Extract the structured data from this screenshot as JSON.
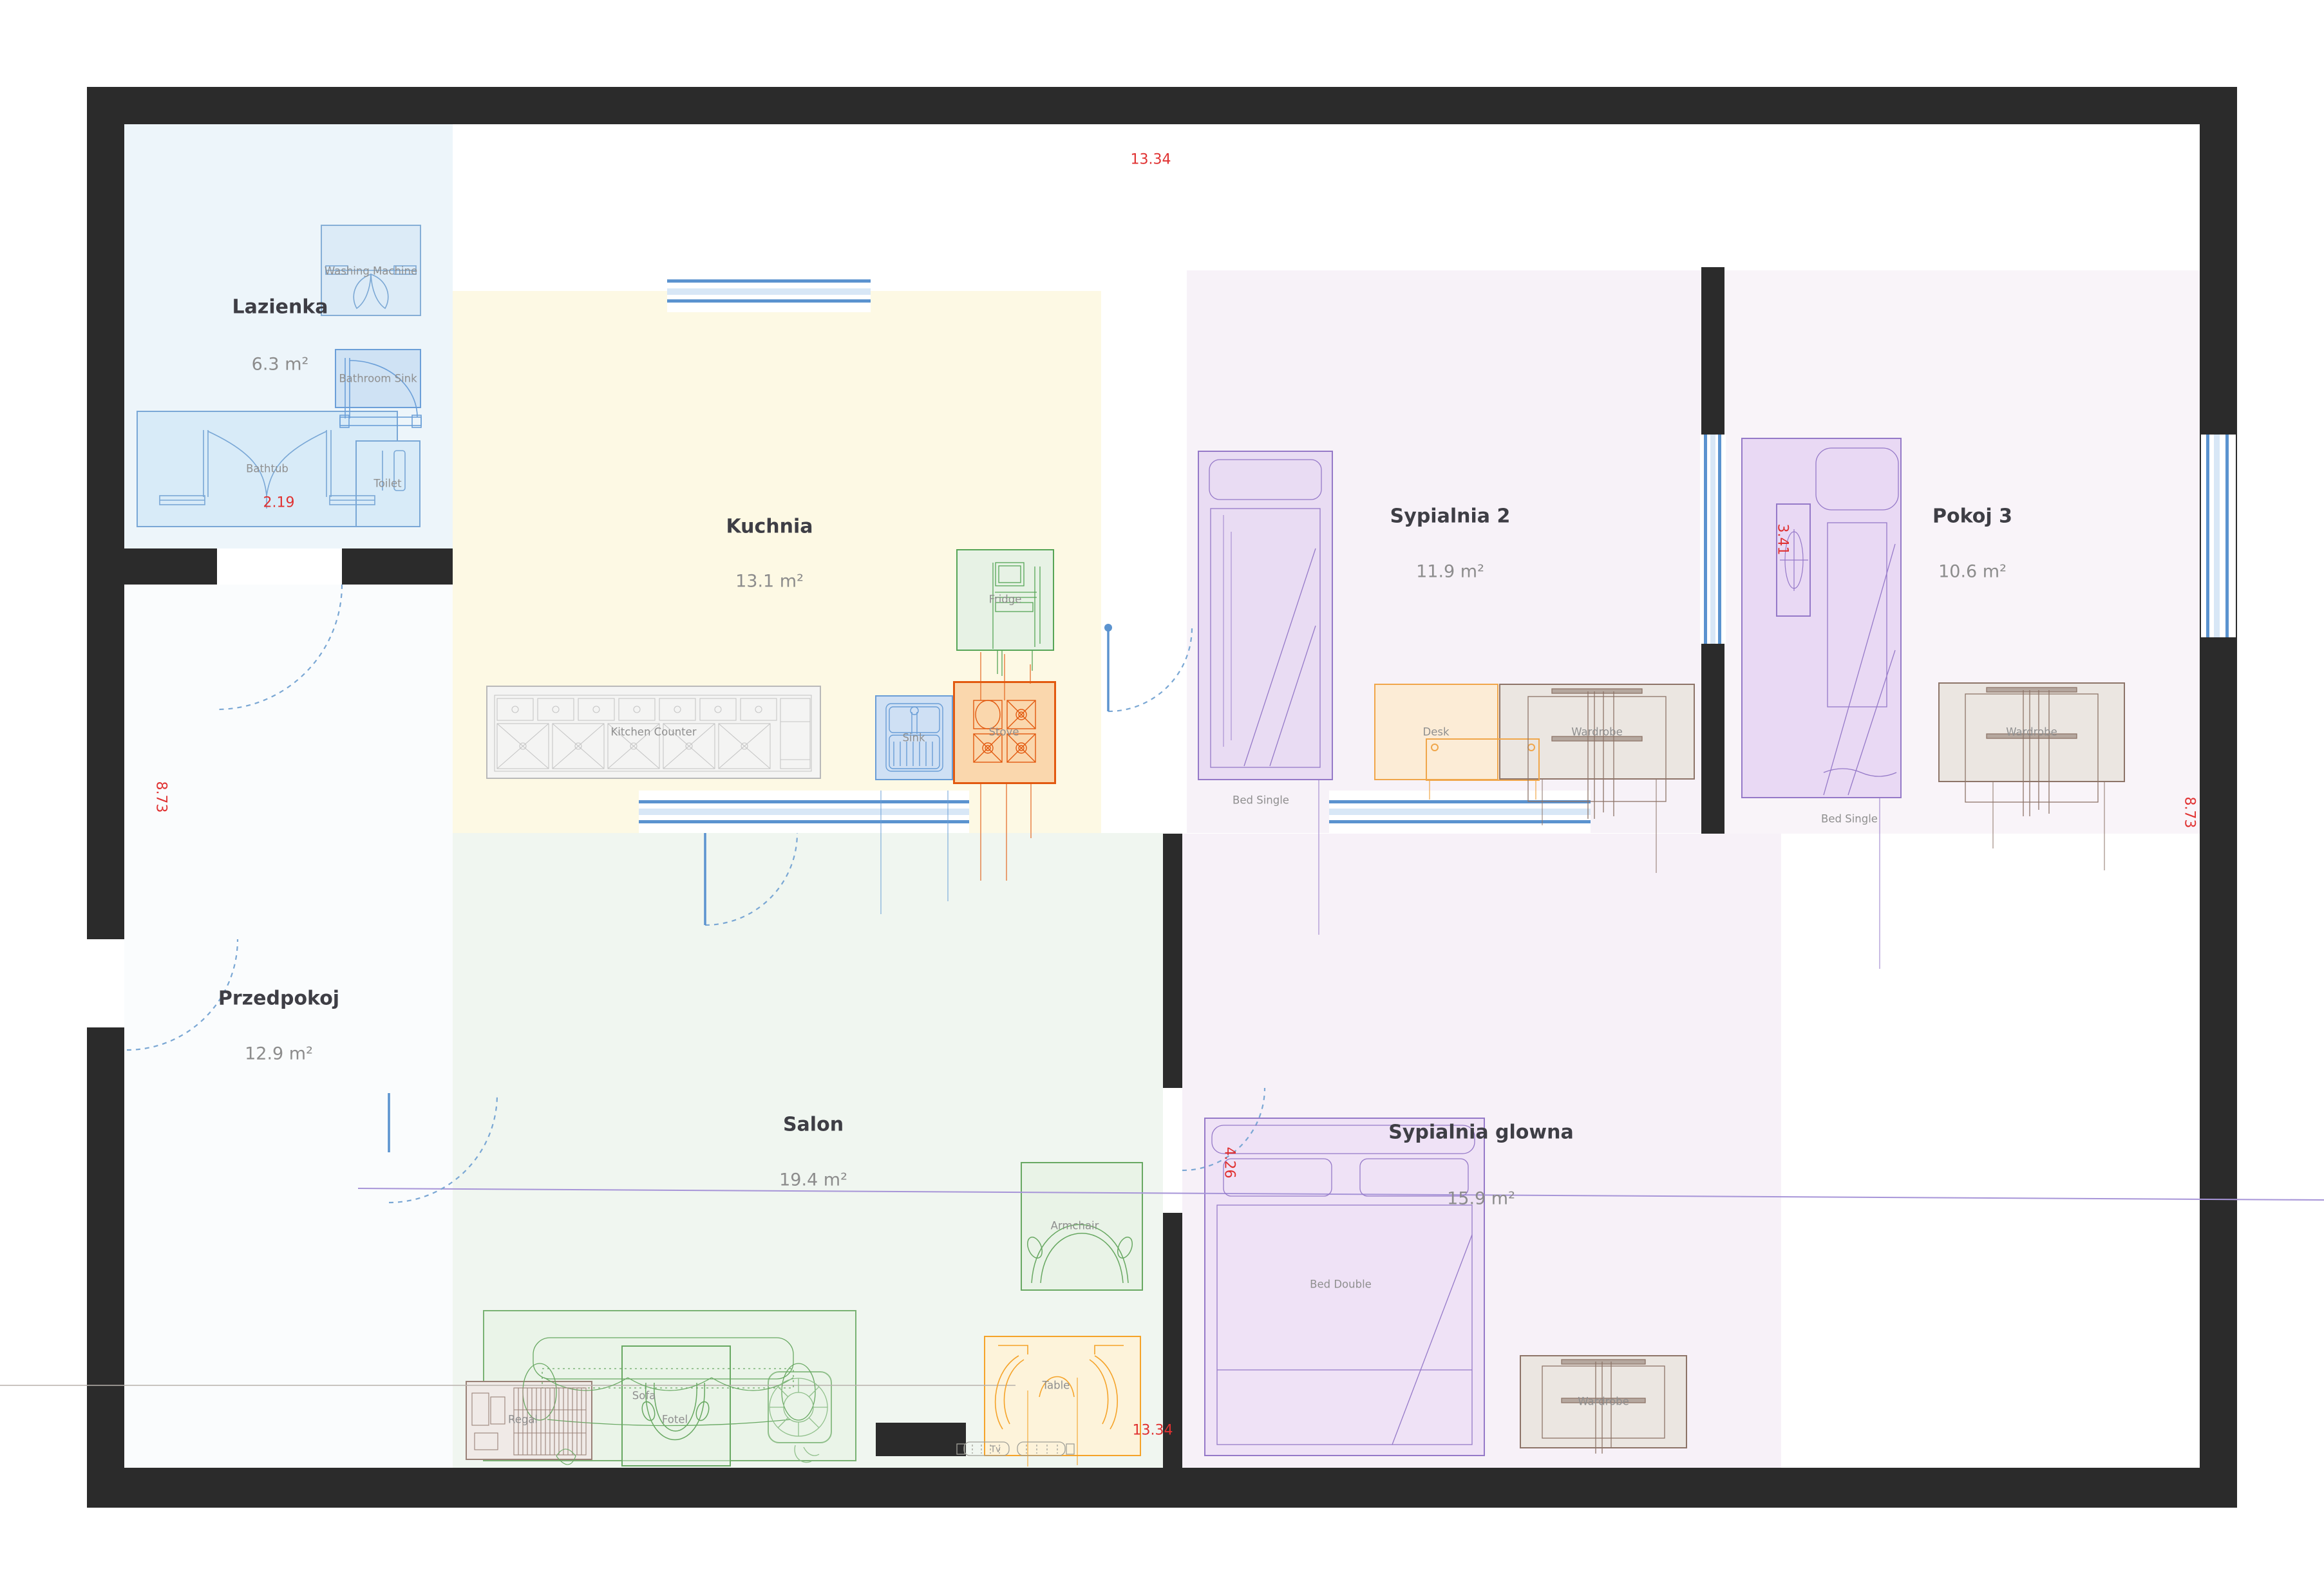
{
  "title": "Floor plan",
  "rooms": [
    {
      "id": "lazienka",
      "name": "Lazienka",
      "area": "6.3 m²"
    },
    {
      "id": "kuchnia",
      "name": "Kuchnia",
      "area": "13.1 m²"
    },
    {
      "id": "sypialnia2",
      "name": "Sypialnia 2",
      "area": "11.9 m²"
    },
    {
      "id": "pokoj3",
      "name": "Pokoj 3",
      "area": "10.6 m²"
    },
    {
      "id": "przedpokoj",
      "name": "Przedpokoj",
      "area": "12.9 m²"
    },
    {
      "id": "salon",
      "name": "Salon",
      "area": "19.4 m²"
    },
    {
      "id": "sypialnia_glowna",
      "name": "Sypialnia glowna",
      "area": "15.9 m²"
    }
  ],
  "furniture": {
    "washing_machine": "Washing Machine",
    "bathroom_sink": "Bathroom Sink",
    "bathtub": "Bathtub",
    "toilet": "Toilet",
    "fridge": "Fridge",
    "kitchen_counter": "Kitchen Counter",
    "sink": "Sink",
    "stove": "Stove",
    "bed_single_2": "Bed Single",
    "desk": "Desk",
    "wardrobe_2": "Wardrobe",
    "bed_single_3": "Bed Single",
    "wardrobe_3": "Wardrobe",
    "bed_double": "Bed Double",
    "wardrobe_main": "Wardrobe",
    "armchair": "Armchair",
    "sofa": "Sofa",
    "fotel": "Fotel",
    "regal": "Regal",
    "table": "Table",
    "tv": "Tv"
  },
  "dimensions": {
    "top": "13.34",
    "bottom": "13.34",
    "left": "8.73",
    "right": "8.73",
    "bathtub_width": "2.19",
    "pokoj3_bed": "3.41",
    "sypialnia_glowna_bed": "4.26"
  },
  "colors": {
    "wall": "#2b2b2b",
    "dimension_red": "#e03131",
    "window_blue": "#5b93cf",
    "window_light": "#d8e7f6",
    "door_blue": "#7aa7d4",
    "bath_fill": "#d8ebf8",
    "kitchen_fill": "#fdf9e4",
    "salon_fill": "#f0f6f0",
    "bedroom_fill": "#f7f2f8",
    "green_accent": "#68a862",
    "orange_accent": "#e2590f",
    "purple_accent": "#9579c8",
    "brown_accent": "#8d7468"
  }
}
